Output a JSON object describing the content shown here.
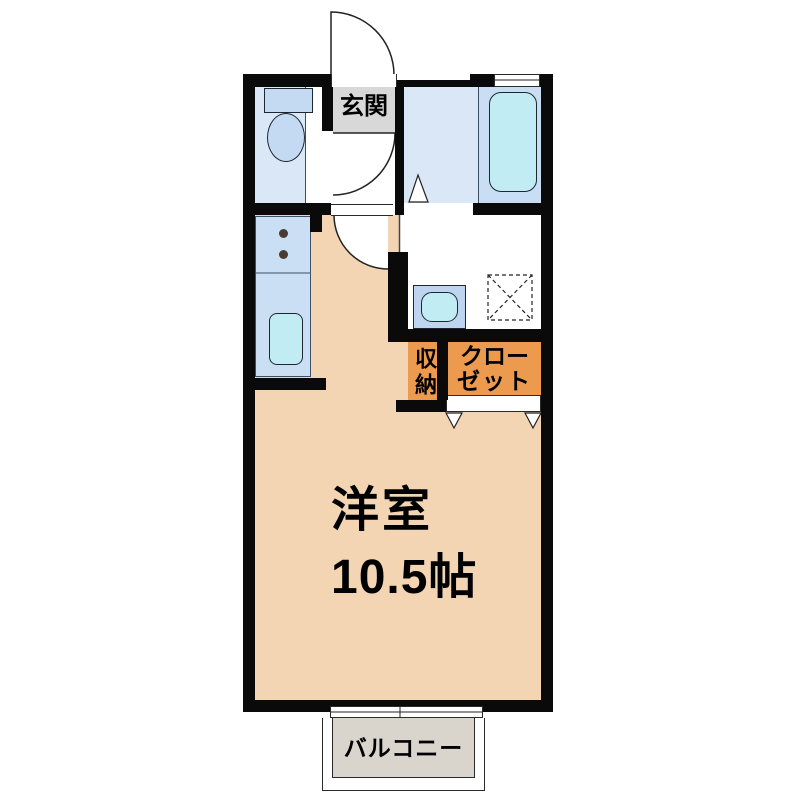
{
  "rooms": {
    "entrance": {
      "label": "玄関"
    },
    "main_room": {
      "name": "洋室",
      "size": "10.5帖"
    },
    "storage": {
      "label": "収納"
    },
    "closet": {
      "label": "クローゼット",
      "line1": "クロー",
      "line2": "ゼット"
    },
    "balcony": {
      "label": "バルコニー"
    }
  },
  "colors": {
    "wall": "#0a0a0a",
    "line": "#2a2a2a",
    "floor-blue": "#d9e7f7",
    "fixture-blue": "#c4daf3",
    "panel-blue": "#c9def3",
    "counter-blue": "#cbdff4",
    "cyan": "#c2ecf4",
    "basin-blue": "#bfd5ef",
    "genkan-gray": "#d8d8d8",
    "orange": "#eb9a4e",
    "peach": "#f3d4b3",
    "balcony-gray": "#d9d5cd",
    "text": "#000000"
  }
}
